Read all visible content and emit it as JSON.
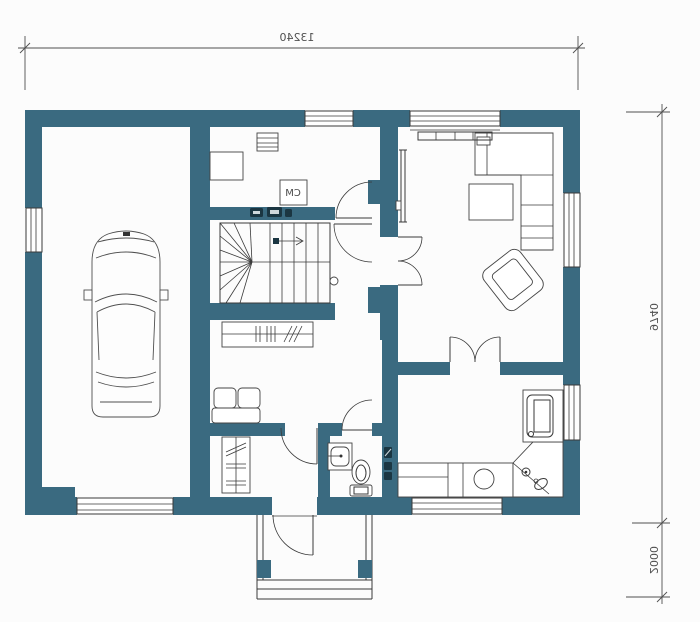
{
  "title": "House ground floor plan (mirrored architectural drawing)",
  "colors": {
    "wall": "#3a6a80",
    "line": "#3a3a3a",
    "dim_line": "#4f4f4f",
    "dark_fixture": "#1b3642",
    "background": "#fcfcfc"
  },
  "dimensions": {
    "mirrored_text": true,
    "top_width": {
      "label": "13240"
    },
    "right_height": {
      "label": "9740"
    },
    "porch_depth": {
      "label": "2000"
    }
  },
  "labels": {
    "utility_box": "CM"
  },
  "components": [
    "car",
    "staircase",
    "stair-direction-arrow",
    "wardrobe-with-hangers",
    "hall-sofa",
    "corner-sofa",
    "armchair",
    "coffee-table",
    "tv",
    "desk",
    "small-appliance",
    "boiler-box-cm",
    "radiator",
    "kitchen-counter",
    "kitchen-sink",
    "corner-hob",
    "oven",
    "wash-basin",
    "toilet",
    "electrical-switches",
    "windows",
    "garage-door",
    "entrance-porch",
    "porch-steps",
    "double-swing-doors"
  ]
}
